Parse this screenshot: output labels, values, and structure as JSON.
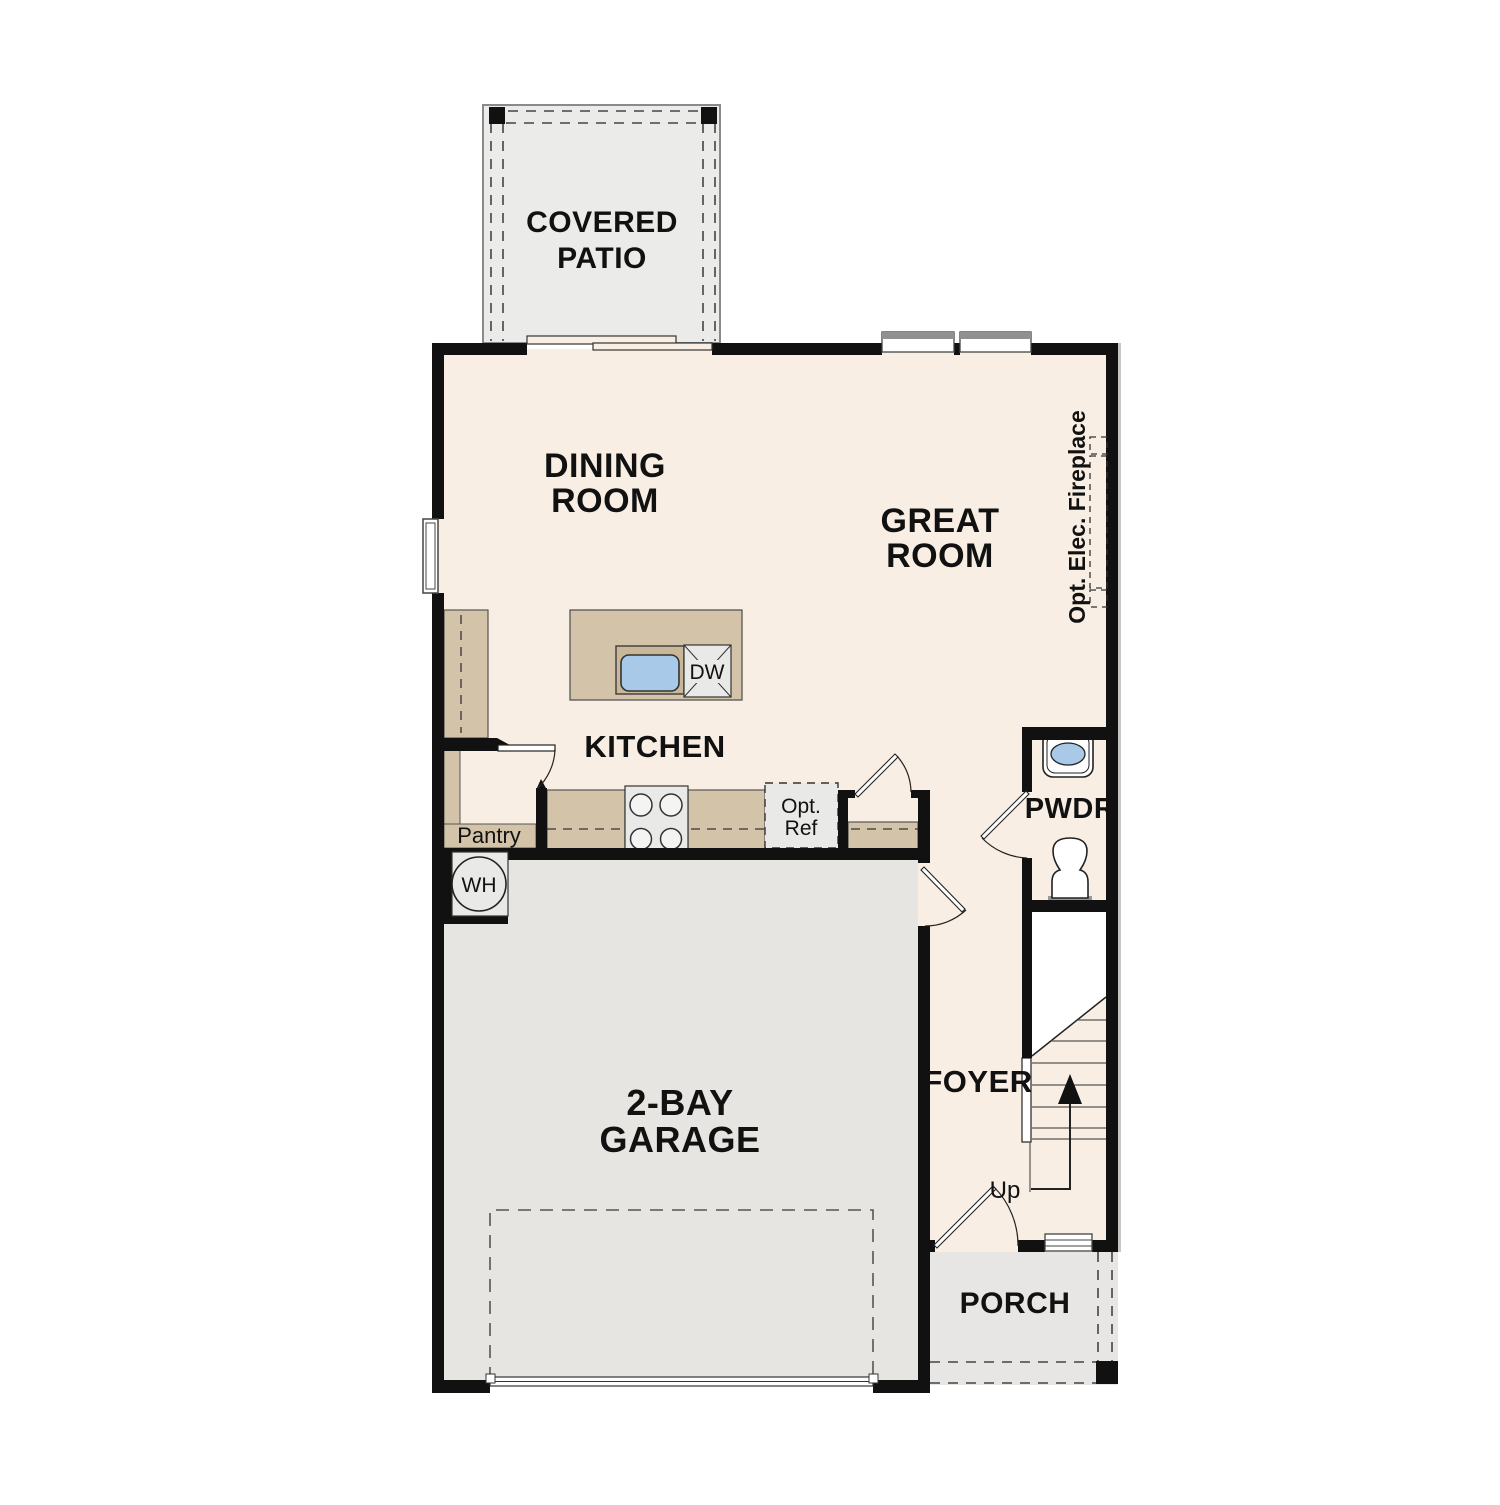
{
  "title": "First floor plan",
  "rooms": {
    "covered_patio": {
      "line1": "COVERED",
      "line2": "PATIO"
    },
    "dining_room": {
      "line1": "DINING",
      "line2": "ROOM"
    },
    "great_room": {
      "line1": "GREAT",
      "line2": "ROOM"
    },
    "kitchen": {
      "label": "KITCHEN"
    },
    "pantry": {
      "label": "Pantry"
    },
    "powder_room": {
      "label": "PWDR"
    },
    "foyer": {
      "label": "FOYER"
    },
    "garage": {
      "line1": "2-BAY",
      "line2": "GARAGE"
    },
    "porch": {
      "label": "PORCH"
    }
  },
  "annotations": {
    "fireplace": "Opt. Elec. Fireplace",
    "opt_ref_line1": "Opt.",
    "opt_ref_line2": "Ref",
    "dishwasher": "DW",
    "water_heater": "WH",
    "stairs_up": "Up"
  },
  "colors": {
    "floor": "#f8eee3",
    "counter_tan": "#d3c4a9",
    "garage_gray": "#e6e5e2",
    "patio_gray": "#ebebe9",
    "porch_gray": "#e7e6e4",
    "wall_black": "#111111",
    "sink_blue": "#a9c9e9",
    "appliance_gray": "#e9e9e7"
  }
}
